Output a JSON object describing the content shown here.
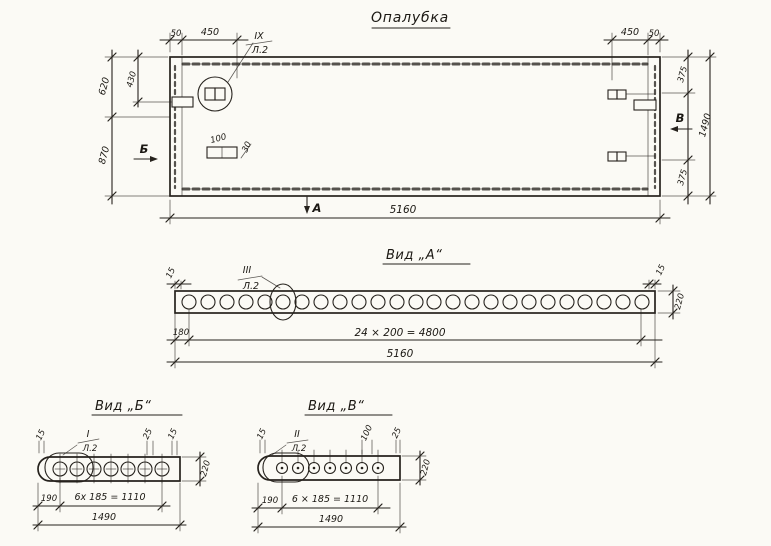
{
  "page": {
    "background": "#fbfaf5",
    "ink": "#26221d"
  },
  "title": "Опалубка",
  "plan": {
    "callout": {
      "num": "IX",
      "sheet": "Л.2"
    },
    "markers": {
      "a": "А",
      "b": "Б",
      "v": "В"
    },
    "dims": {
      "gap_left": "50",
      "panel_left": "450",
      "panel_right": "450",
      "gap_right": "50",
      "left_top": "620",
      "left_inner": "430",
      "left_bottom": "870",
      "right_top": "375",
      "right_bottom": "375",
      "right_total": "1490",
      "length_total": "5160",
      "detail_width": "100",
      "detail_height": "30"
    }
  },
  "view_a": {
    "title": "Вид „А“",
    "callout": {
      "num": "III",
      "sheet": "Л.2"
    },
    "hole_count": 25,
    "dims": {
      "edge_left": "15",
      "edge_right": "15",
      "height": "220",
      "first_offset": "180",
      "hole_spacing": "24 × 200 = 4800",
      "length_total": "5160"
    }
  },
  "view_b": {
    "title": "Вид „Б“",
    "callout": {
      "num": "I",
      "sheet": "Л.2"
    },
    "hole_count": 7,
    "dims": {
      "edge_left": "15",
      "mid": "25",
      "edge_right": "15",
      "height": "220",
      "first_offset": "190",
      "hole_spacing": "6х 185 = 1110",
      "length_total": "1490"
    }
  },
  "view_v": {
    "title": "Вид „В“",
    "callout": {
      "num": "II",
      "sheet": "Л.2"
    },
    "hole_count": 7,
    "dims": {
      "edge_left": "15",
      "mid": "100",
      "edge_right": "25",
      "height": "220",
      "first_offset": "190",
      "hole_spacing": "6 × 185 = 1110",
      "length_total": "1490"
    }
  }
}
